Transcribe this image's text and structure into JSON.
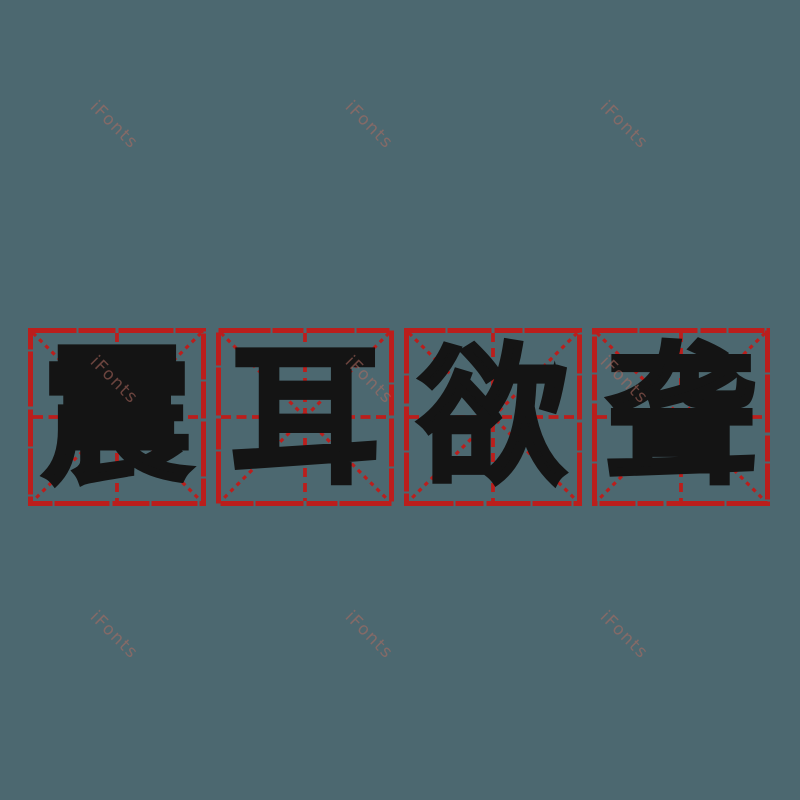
{
  "canvas": {
    "background_color": "#4c6870"
  },
  "watermark": {
    "text": "iFonts",
    "count": 9,
    "color": "#b26c60",
    "rotation_deg": 45
  },
  "phrase": {
    "text": "震耳欲聋",
    "characters": [
      "震",
      "耳",
      "欲",
      "聋"
    ],
    "color": "#141414"
  },
  "grid": {
    "type": "mi-zi-ge",
    "cell_count": 4,
    "line_color": "#bb1e1c"
  }
}
